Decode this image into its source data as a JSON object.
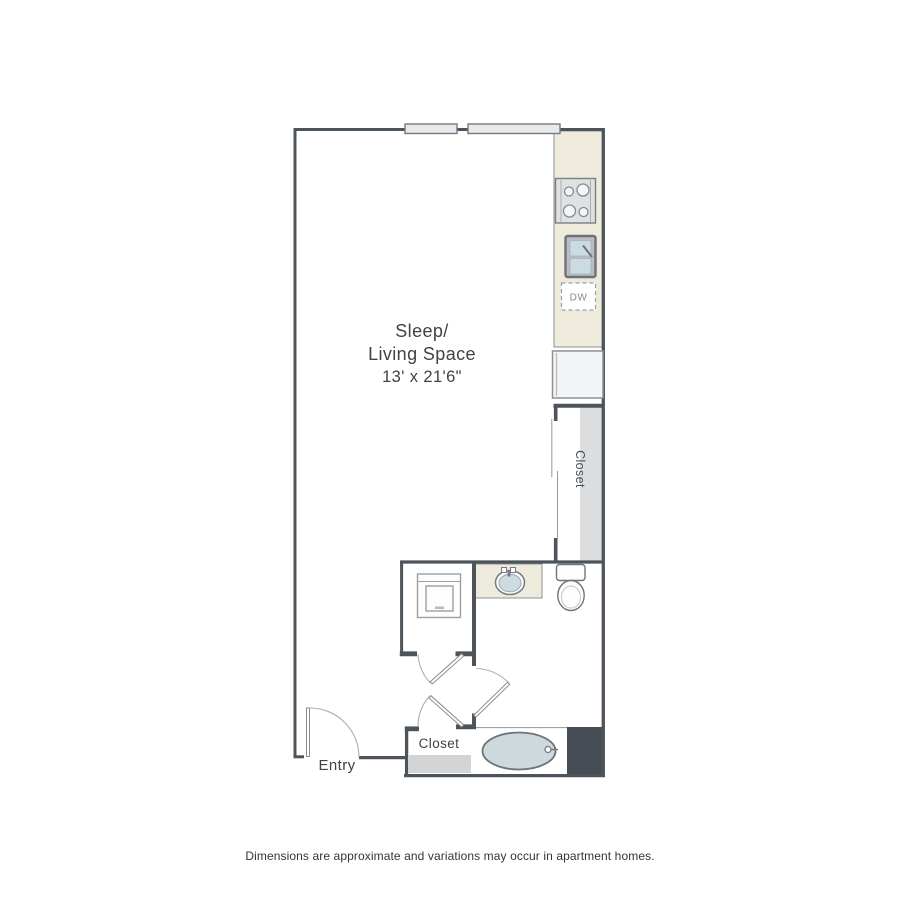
{
  "floorplan": {
    "living_label": {
      "line1": "Sleep/",
      "line2": "Living Space",
      "dims": "13' x 21'6\""
    },
    "labels": {
      "entry": "Entry",
      "closet_bottom": "Closet",
      "closet_right": "Closet",
      "dishwasher": "DW"
    },
    "footer": {
      "disclaimer": "Dimensions are approximate and variations may occur in apartment homes."
    },
    "colors": {
      "wall": "#4e545c",
      "wall_block": "#474d55",
      "counter": "#eeebdc",
      "window_fill": "#e7e9eb",
      "fixture_water": "#ccdbe2",
      "tub_water": "#cdd9dc",
      "appliance_gray": "#dfe1e3",
      "closet_shade": "#dcddde",
      "closet_floor_shade": "#d2d4d6"
    }
  }
}
